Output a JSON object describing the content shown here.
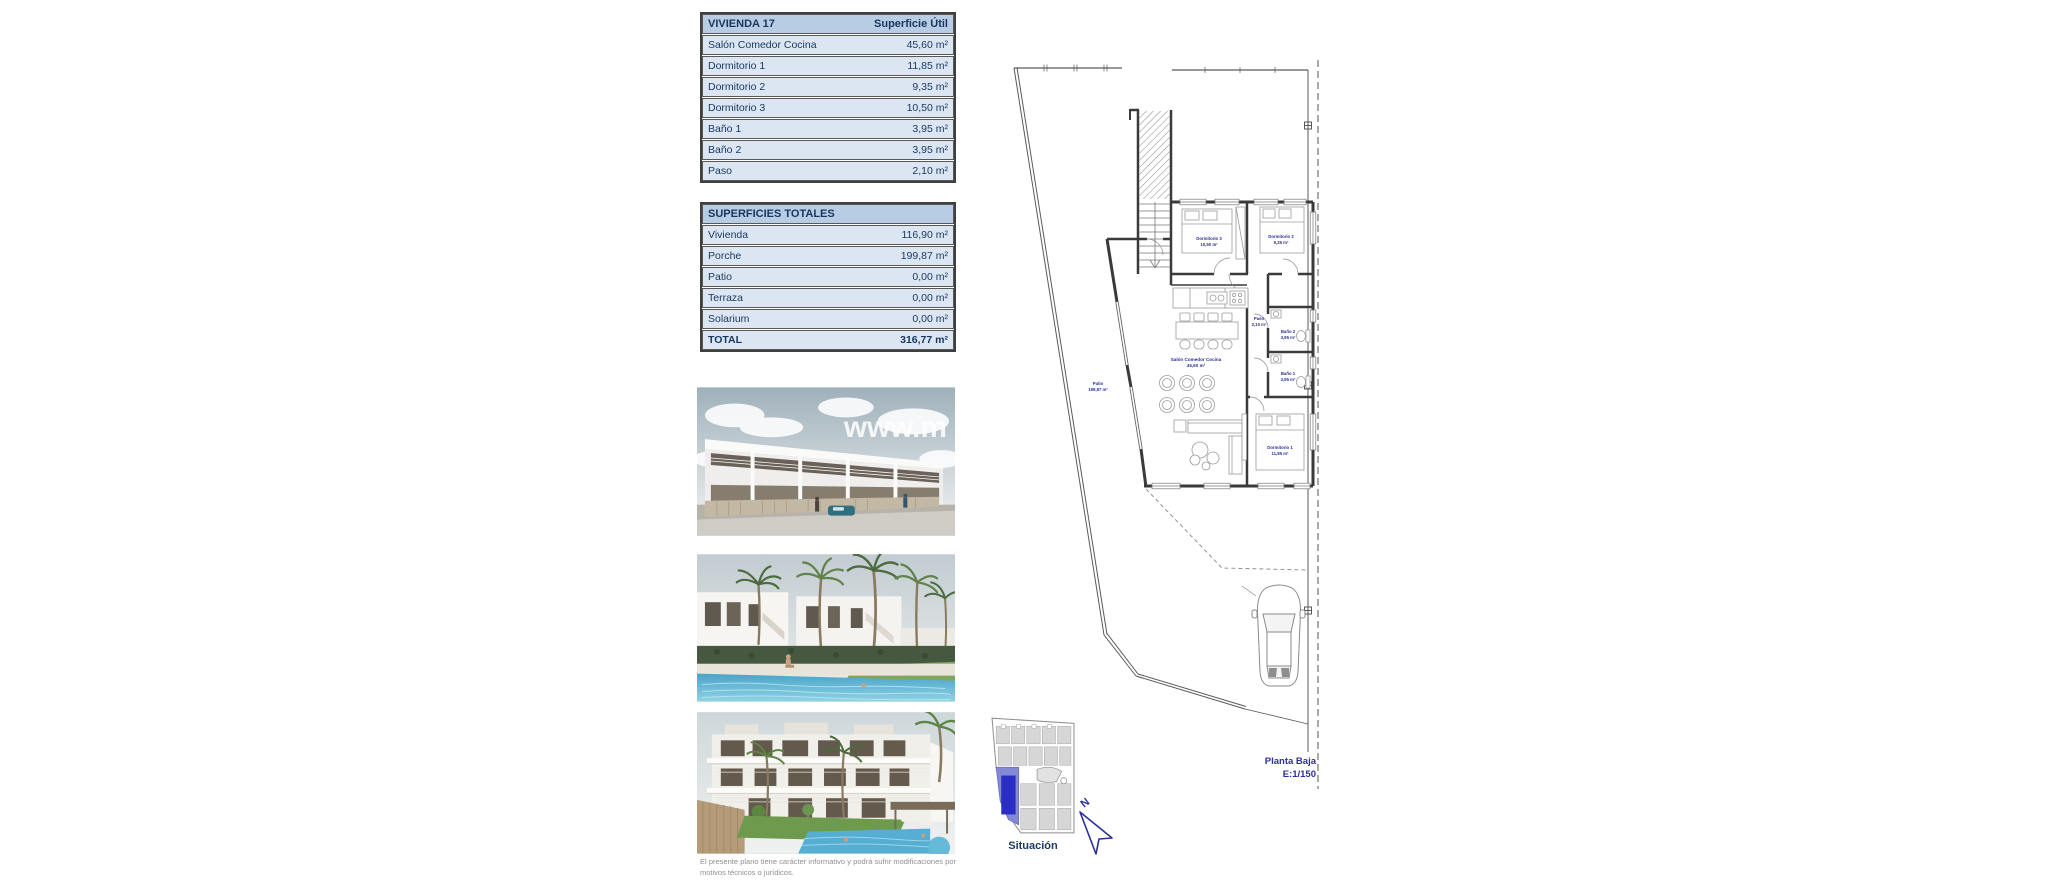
{
  "vivienda_table": {
    "header": {
      "left": "VIVIENDA 17",
      "right": "Superficie Útil"
    },
    "rows": [
      {
        "label": "Salón Comedor Cocina",
        "value": "45,60 m²"
      },
      {
        "label": "Dormitorio 1",
        "value": "11,85 m²"
      },
      {
        "label": "Dormitorio 2",
        "value": "9,35 m²"
      },
      {
        "label": "Dormitorio 3",
        "value": "10,50 m²"
      },
      {
        "label": "Baño 1",
        "value": "3,95 m²"
      },
      {
        "label": "Baño 2",
        "value": "3,95 m²"
      },
      {
        "label": "Paso",
        "value": "2,10 m²"
      }
    ]
  },
  "totales_table": {
    "header": "SUPERFICIES TOTALES",
    "rows": [
      {
        "label": "Vivienda",
        "value": "116,90 m²"
      },
      {
        "label": "Porche",
        "value": "199,87 m²"
      },
      {
        "label": "Patio",
        "value": "0,00 m²"
      },
      {
        "label": "Terraza",
        "value": "0,00 m²"
      },
      {
        "label": "Solarium",
        "value": "0,00 m²"
      }
    ],
    "total": {
      "label": "TOTAL",
      "value": "316,77 m²"
    }
  },
  "photos": {
    "watermark": "www.m"
  },
  "plan": {
    "title": "Planta Baja",
    "scale": "E:1/150",
    "north_label": "N",
    "rooms": {
      "dormitorio3": {
        "name": "Dormitorio 3",
        "area": "10,50 m²"
      },
      "dormitorio2": {
        "name": "Dormitorio 2",
        "area": "9,35 m²"
      },
      "paso": {
        "name": "Paso",
        "area": "2,10 m²"
      },
      "bano2": {
        "name": "Baño 2",
        "area": "3,95 m²"
      },
      "bano1": {
        "name": "Baño 1",
        "area": "3,95 m²"
      },
      "salon": {
        "name": "Salón Comedor Cocina",
        "area": "45,60 m²"
      },
      "dormitorio1": {
        "name": "Dormitorio 1",
        "area": "11,85 m²"
      },
      "patio": {
        "name": "Patio",
        "area": "199,87 m²"
      }
    }
  },
  "situacion": {
    "label": "Situación"
  },
  "disclaimer": "El presente plano tiene carácter informativo y podrá sufrir modificaciones por motivos técnicos o jurídicos.",
  "colors": {
    "table_header_bg": "#b8cce4",
    "table_row_bg": "#dce6f2",
    "table_text": "#17375e",
    "plan_label": "#2b3192",
    "situacion_highlight": "#2a2ec4"
  }
}
